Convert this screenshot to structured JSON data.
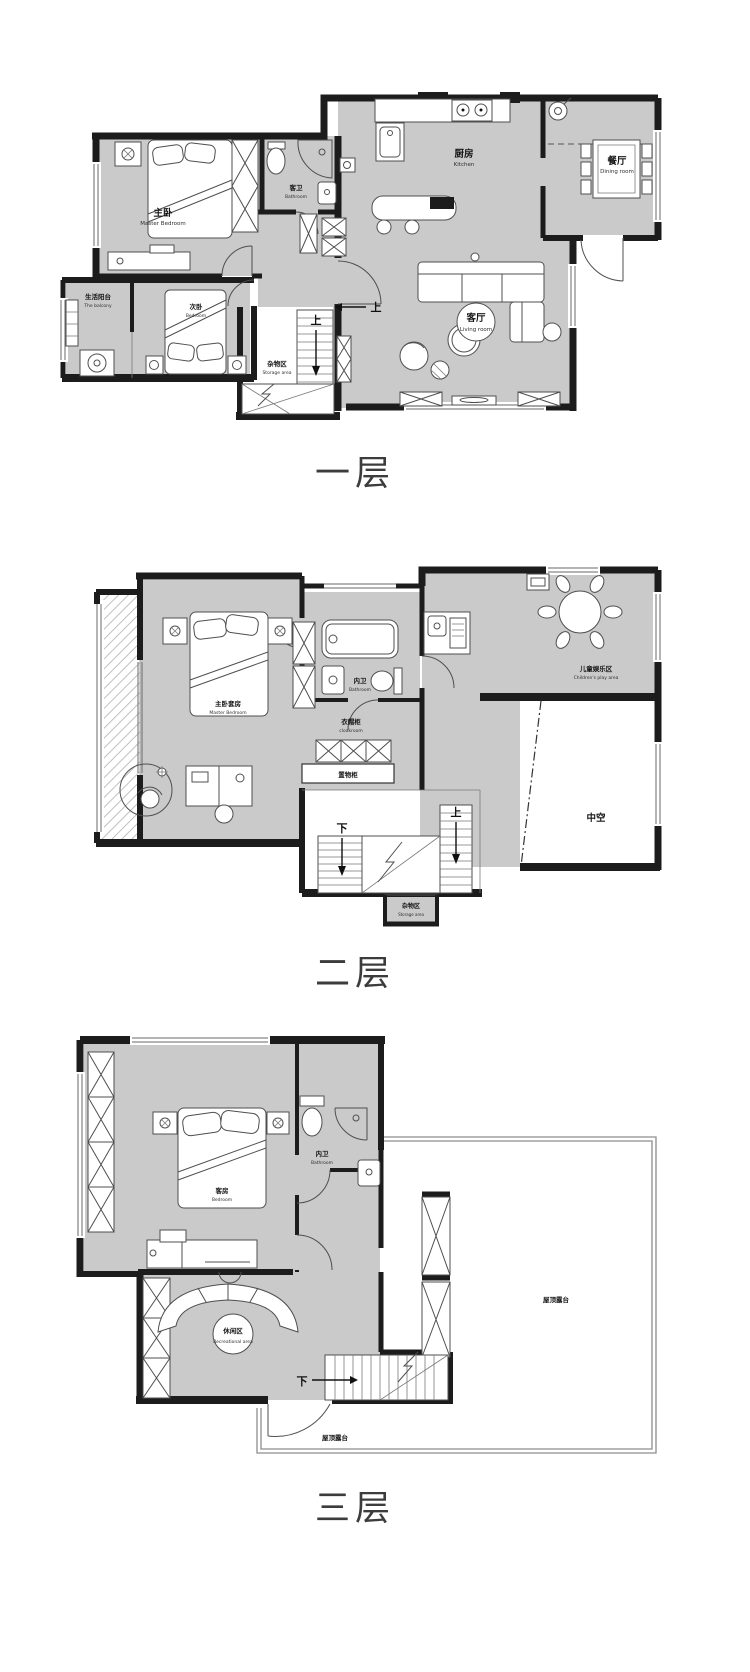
{
  "page": {
    "background": "#ffffff"
  },
  "floors": [
    {
      "title": "一层",
      "rooms": {
        "master_bedroom": {
          "cn": "主卧",
          "en": "Master Bedroom"
        },
        "bathroom": {
          "cn": "客卫",
          "en": "Bathroom"
        },
        "kitchen": {
          "cn": "厨房",
          "en": "Kitchen"
        },
        "dining": {
          "cn": "餐厅",
          "en": "Dining room"
        },
        "living": {
          "cn": "客厅",
          "en": "Living room"
        },
        "balcony": {
          "cn": "生活阳台",
          "en": "The balcony"
        },
        "second_bedroom": {
          "cn": "次卧",
          "en": "Bedroom"
        },
        "storage": {
          "cn": "杂物区",
          "en": "Storage area"
        }
      },
      "directions": {
        "stair_up": "上",
        "entry_up": "上"
      }
    },
    {
      "title": "二层",
      "rooms": {
        "master_suite": {
          "cn": "主卧套房",
          "en": "Master Bedroom"
        },
        "bathroom": {
          "cn": "内卫",
          "en": "Bathroom"
        },
        "cloakroom": {
          "cn": "衣帽柜",
          "en": "cloakroom"
        },
        "play_area": {
          "cn": "儿童娱乐区",
          "en": "Children's play area"
        },
        "void": {
          "cn": "中空"
        },
        "cabinet": {
          "cn": "置物柜"
        },
        "storage": {
          "cn": "杂物区",
          "en": "Storage area"
        }
      },
      "directions": {
        "stair_down": "下",
        "stair_up": "上"
      }
    },
    {
      "title": "三层",
      "rooms": {
        "guest_bedroom": {
          "cn": "客房",
          "en": "Bedroom"
        },
        "bathroom": {
          "cn": "内卫",
          "en": "Bathroom"
        },
        "lounge": {
          "cn": "休闲区",
          "en": "Recreational area"
        },
        "roof_terrace_right": {
          "cn": "屋顶露台"
        },
        "roof_terrace_bottom": {
          "cn": "屋顶露台"
        }
      },
      "directions": {
        "stair_down": "下"
      }
    }
  ]
}
